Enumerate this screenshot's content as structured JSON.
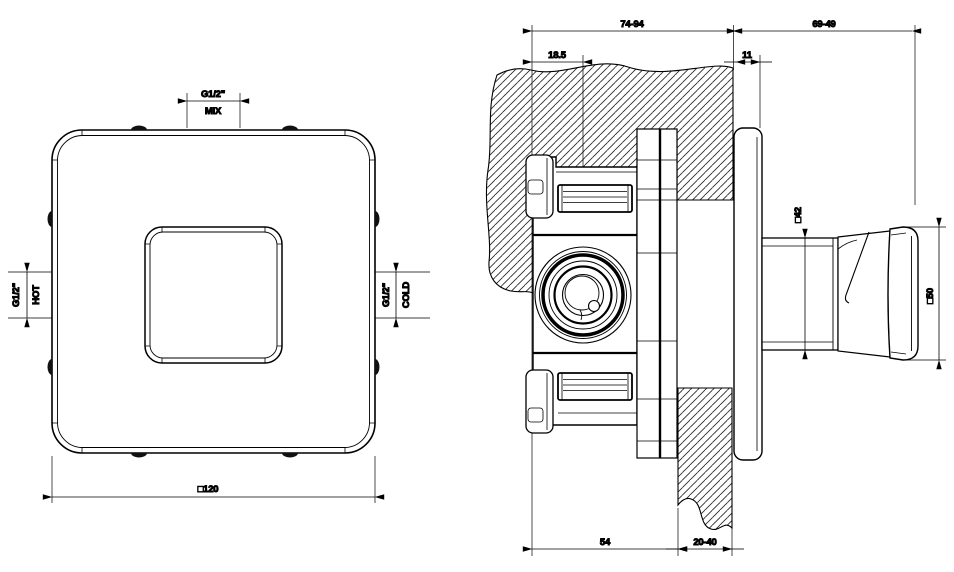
{
  "front_view": {
    "mix_thread": "G1/2\"",
    "mix_label": "MIX",
    "hot_thread": "G1/2\"",
    "hot_label": "HOT",
    "cold_thread": "G1/2\"",
    "cold_label": "COLD",
    "overall_size": "□120"
  },
  "section_view": {
    "recess_depth_range": "74-94",
    "protrusion_range": "69-49",
    "port_axis_depth": "18.5",
    "plate_thickness": "11",
    "body_depth": "54",
    "wall_thickness_range": "20-40",
    "stem_size": "□42",
    "knob_size": "□50"
  },
  "colors": {
    "line": "#000000",
    "background": "#ffffff"
  }
}
